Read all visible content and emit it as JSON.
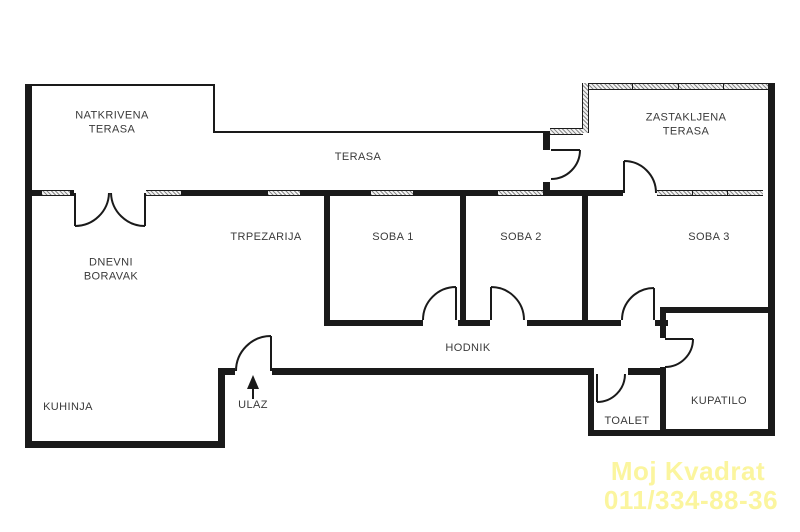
{
  "rooms": {
    "natkrivena_terasa": {
      "label": "NATKRIVENA\nTERASA"
    },
    "terasa": {
      "label": "TERASA"
    },
    "zastakljena_terasa": {
      "label": "ZASTAKLJENA\nTERASA"
    },
    "dnevni_boravak": {
      "label": "DNEVNI\nBORAVAK"
    },
    "trpezarija": {
      "label": "TRPEZARIJA"
    },
    "soba1": {
      "label": "SOBA 1"
    },
    "soba2": {
      "label": "SOBA 2"
    },
    "soba3": {
      "label": "SOBA 3"
    },
    "hodnik": {
      "label": "HODNIK"
    },
    "kuhinja": {
      "label": "KUHINJA"
    },
    "ulaz": {
      "label": "ULAZ"
    },
    "toalet": {
      "label": "TOALET"
    },
    "kupatilo": {
      "label": "KUPATILO"
    }
  },
  "watermark": {
    "line1": "Moj Kvadrat",
    "line2": "011/334-88-36",
    "color": "#fbf59e"
  },
  "colors": {
    "wall": "#1a1a1a",
    "text": "#3a3a3a",
    "window_hatch": "#8a8a8a"
  }
}
